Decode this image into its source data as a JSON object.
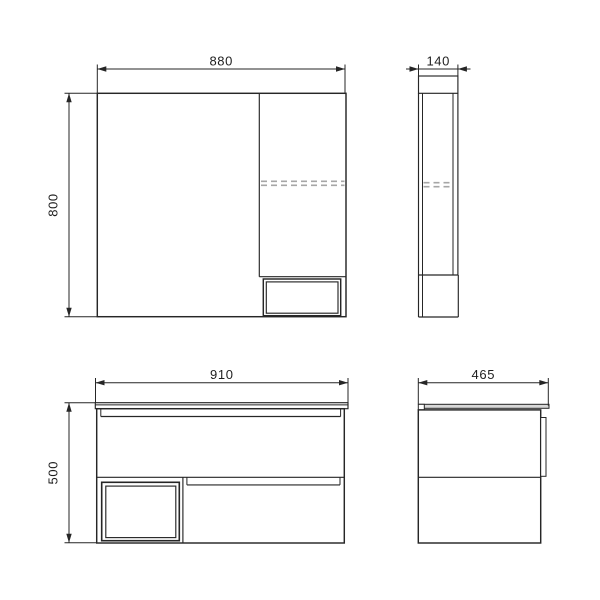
{
  "drawing": {
    "kind": "furniture-dimensional-technical-drawing",
    "description": "Two-piece bathroom set drawn in four orthographic views: mirror cabinet (front and side) on top row, vanity unit with countertop (front and side) on bottom row",
    "views": [
      {
        "id": "mirror-front",
        "name": "mirror cabinet front view",
        "dims": {
          "width": "880",
          "height": "800"
        }
      },
      {
        "id": "mirror-side",
        "name": "mirror cabinet side view",
        "dims": {
          "depth": "140"
        }
      },
      {
        "id": "vanity-front",
        "name": "vanity unit front view",
        "dims": {
          "width": "910",
          "height": "500"
        }
      },
      {
        "id": "vanity-side",
        "name": "vanity unit side view",
        "dims": {
          "depth": "465"
        }
      }
    ],
    "colors": {
      "line": "#262626",
      "dashed_shelf_line": "#a6a6a6",
      "countertop_fill": "#d8d8d8",
      "background": "#ffffff"
    }
  }
}
